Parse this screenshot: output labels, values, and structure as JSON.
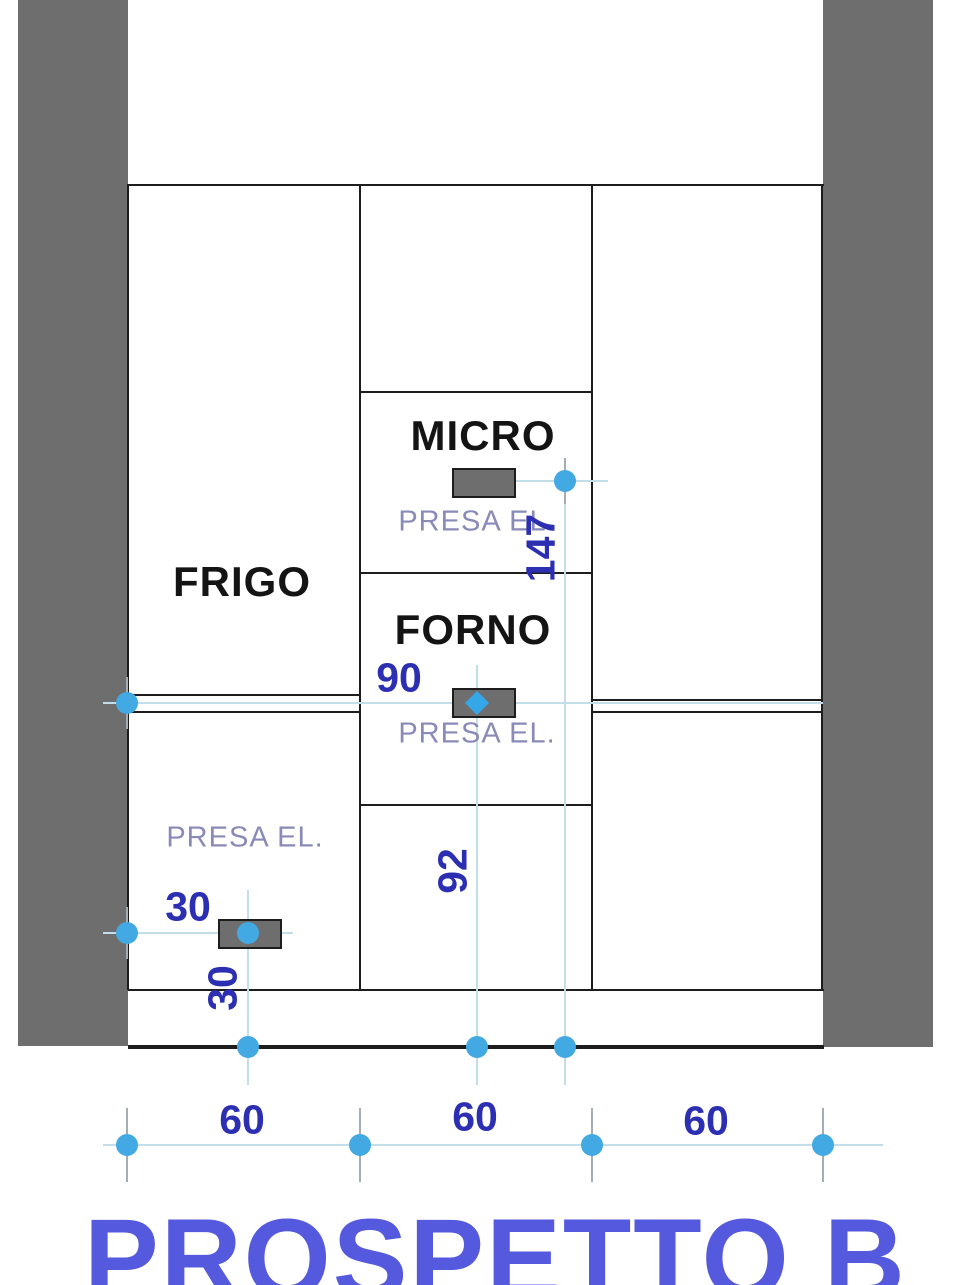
{
  "drawing": {
    "title": "PROSPETTO B",
    "cabinet_labels": {
      "fridge": "FRIGO",
      "microwave": "MICRO",
      "oven": "FORNO"
    },
    "outlet_label": "PRESA EL.",
    "dimensions": {
      "micro_outlet_height": "147",
      "oven_outlet_height": "90",
      "oven_column_height": "92",
      "left_outlet_offset": "30",
      "left_outlet_height": "30",
      "column_widths": [
        "60",
        "60",
        "60"
      ]
    },
    "colors": {
      "wall_gray": "#6e6e6e",
      "dimension_text": "#2d2fb2",
      "outlet_text": "#8a8ab8",
      "title_text": "#5559dd",
      "marker_blue": "#42a9e2",
      "dimension_line": "#c2dfe9"
    }
  }
}
